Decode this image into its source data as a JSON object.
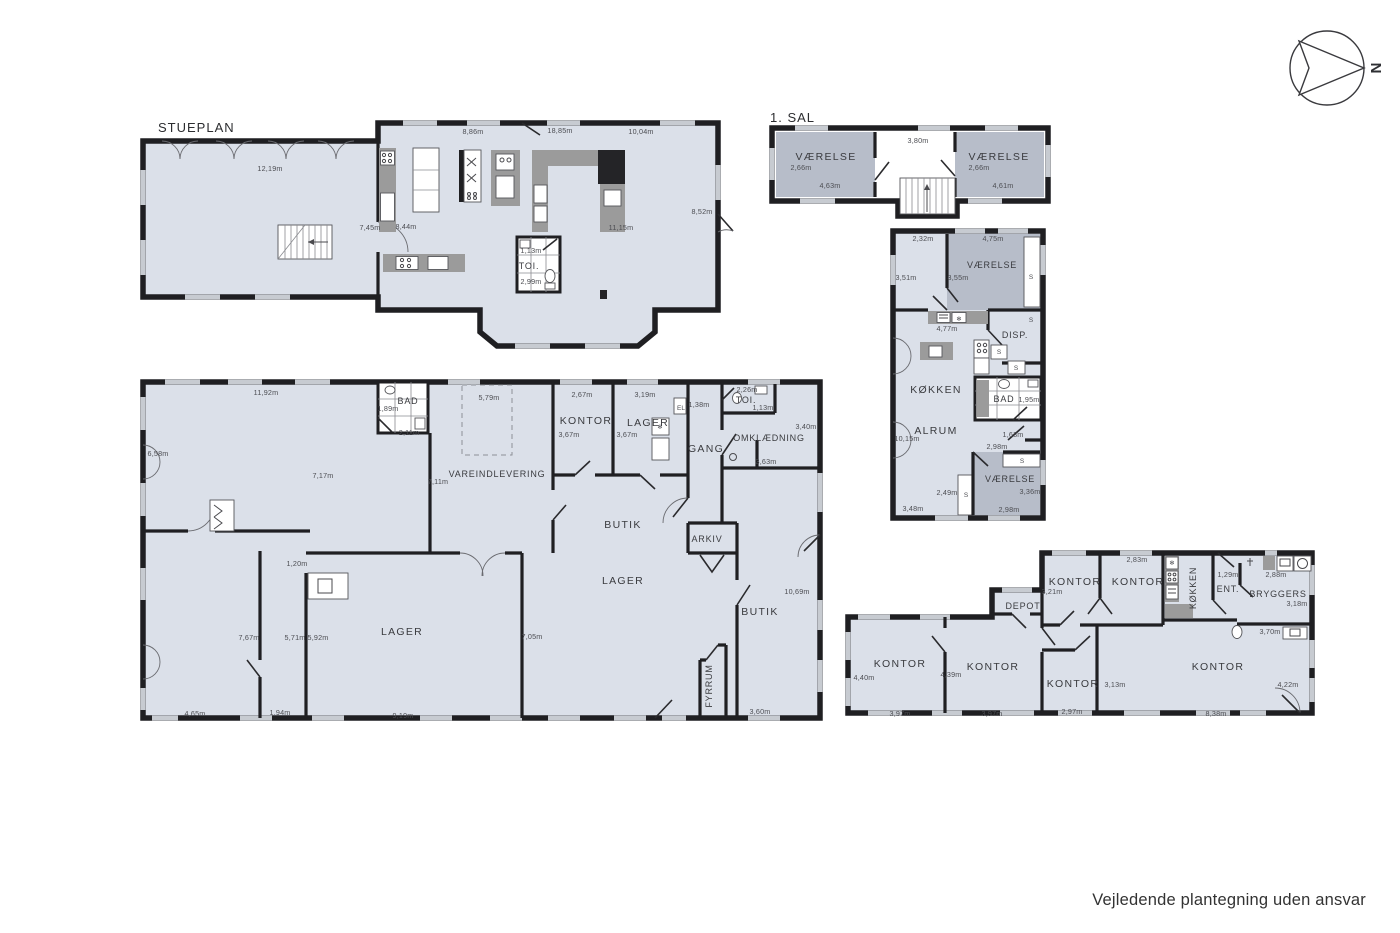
{
  "footer": "Vejledende plantegning uden ansvar",
  "compass": {
    "north": "N"
  },
  "icons": {
    "freezer": "❄"
  },
  "colors": {
    "room_light": "#dbe0e9",
    "room_dark": "#b7bdc9",
    "wall": "#1f1f22",
    "counter": "#9b9b9b",
    "window": "#c7cbd1"
  },
  "stueplan": {
    "title": "STUEPLAN",
    "rooms": {
      "toi": "TOI."
    },
    "dims": {
      "left_top": "12,19m",
      "top1": "8,86m",
      "top2": "18,85m",
      "top3": "10,04m",
      "mid1": "7,45m",
      "mid2": "8,44m",
      "right": "8,52m",
      "kitchen": "11,15m",
      "toi_w": "1,13m",
      "toi_h": "2,99m"
    }
  },
  "sal": {
    "title": "1. SAL",
    "rooms": {
      "left": "VÆRELSE",
      "right": "VÆRELSE"
    },
    "dims": {
      "left_w": "2,66m",
      "left_b": "4,63m",
      "mid_top": "3,80m",
      "right_w": "2,66m",
      "right_b": "4,61m"
    }
  },
  "annex": {
    "rooms": {
      "vaerelse_top": "VÆRELSE",
      "disp": "DISP.",
      "koekken": "KØKKEN",
      "alrum": "ALRUM",
      "bad": "BAD",
      "vaerelse_btm": "VÆRELSE"
    },
    "closet": "S",
    "dims": {
      "top1": "2,32m",
      "top2": "4,75m",
      "left_top": "3,51m",
      "v_top_h": "3,55m",
      "counter": "4,77m",
      "bad_w": "1,95m",
      "alrum_h": "10,15m",
      "d_163": "1,63m",
      "d_298": "2,98m",
      "v_btm_h": "3,36m",
      "d_249": "2,49m",
      "b_348": "3,48m",
      "b_298": "2,98m"
    }
  },
  "hall": {
    "rooms": {
      "bad": "BAD",
      "vareindlevering": "VAREINDLEVERING",
      "kontor": "KONTOR",
      "lager_small": "LAGER",
      "gang": "GANG",
      "toi": "TOI.",
      "omklaedning": "OMKLÆDNING",
      "butik_top": "BUTIK",
      "arkiv": "ARKIV",
      "lager_big": "LAGER",
      "butik_right": "BUTIK",
      "lager_left": "LAGER",
      "fyrrum": "FYRRUM"
    },
    "el": "EL",
    "dims": {
      "top": "11,92m",
      "left": "6,58m",
      "bad_w": "1,89m",
      "bad_b": "2,11m",
      "dock": "5,79m",
      "mid_h": "7,17m",
      "varein_h": "7,11m",
      "kontor_w": "2,67m",
      "kontor_h": "3,67m",
      "lager_w": "3,19m",
      "lager_h": "3,67m",
      "gang_w": "1,38m",
      "toi_w": "2,26m",
      "toi_b": "1,13m",
      "omk_r": "3,40m",
      "omk_b": "3,63m",
      "p_120": "1,20m",
      "p_767": "7,67m",
      "p_571": "5,71m",
      "p_592": "5,92m",
      "butik_h": "10,69m",
      "lager_mid_h": "7,05m",
      "b_465": "4,65m",
      "b_194": "1,94m",
      "b_919": "9,19m",
      "b_360": "3,60m"
    }
  },
  "office": {
    "rooms": {
      "depot": "DEPOT",
      "kontor_t1": "KONTOR",
      "kontor_t2": "KONTOR",
      "koekken": "KØKKEN",
      "ent": "ENT.",
      "bryggers": "BRYGGERS",
      "kontor_b1": "KONTOR",
      "kontor_b2": "KONTOR",
      "kontor_b3": "KONTOR",
      "kontor_b4": "KONTOR"
    },
    "dims": {
      "t1_w": "3,21m",
      "t1_top": "2,83m",
      "ent_w": "1,29m",
      "br_top": "2,88m",
      "br_r": "3,18m",
      "br_b": "3,70m",
      "b1_h": "4,40m",
      "b1_b": "3,97m",
      "b2_h": "4,39m",
      "b2_b": "3,97m",
      "b3_b": "2,97m",
      "b3_h": "3,13m",
      "b4_b": "8,38m",
      "b4_h": "4,22m"
    }
  }
}
